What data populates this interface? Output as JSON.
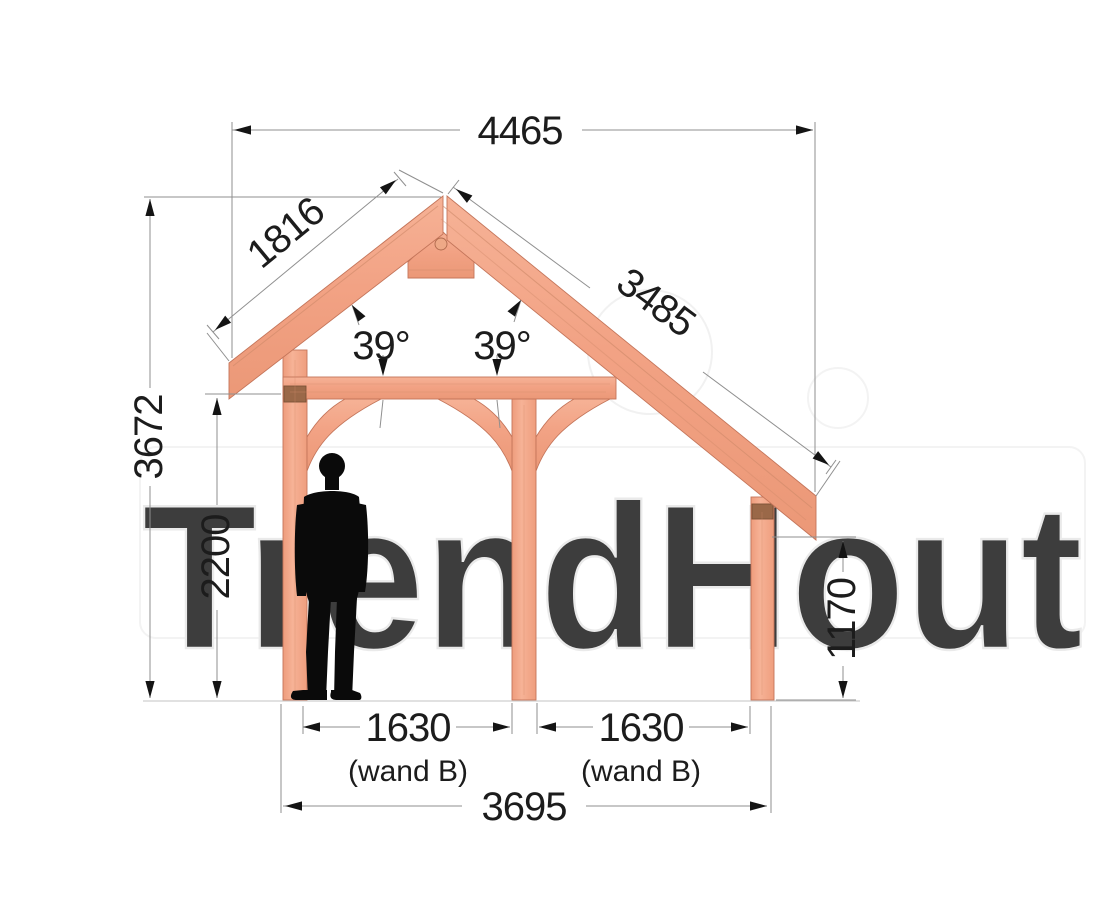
{
  "drawing": {
    "watermark": "TrendHout",
    "dims": {
      "roof_total_width": "4465",
      "left_rafter_length": "1816",
      "right_rafter_length": "3485",
      "roof_angle_left": "39°",
      "roof_angle_right": "39°",
      "overall_height": "3672",
      "passage_height": "2200",
      "right_wall_height": "1170",
      "bay_left": "1630",
      "bay_left_note": "(wand B)",
      "bay_right": "1630",
      "bay_right_note": "(wand B)",
      "post_span": "3695"
    },
    "colors": {
      "timber": "#f2a284",
      "timber_light": "#f8bfa2",
      "timber_edge": "#c4755a",
      "end_grain": "#9a6848",
      "dim_line": "#8f8f8f",
      "dim_text": "#1c1c1c",
      "silhouette": "#0a0a0a",
      "watermark": "#e7e7e7"
    }
  }
}
